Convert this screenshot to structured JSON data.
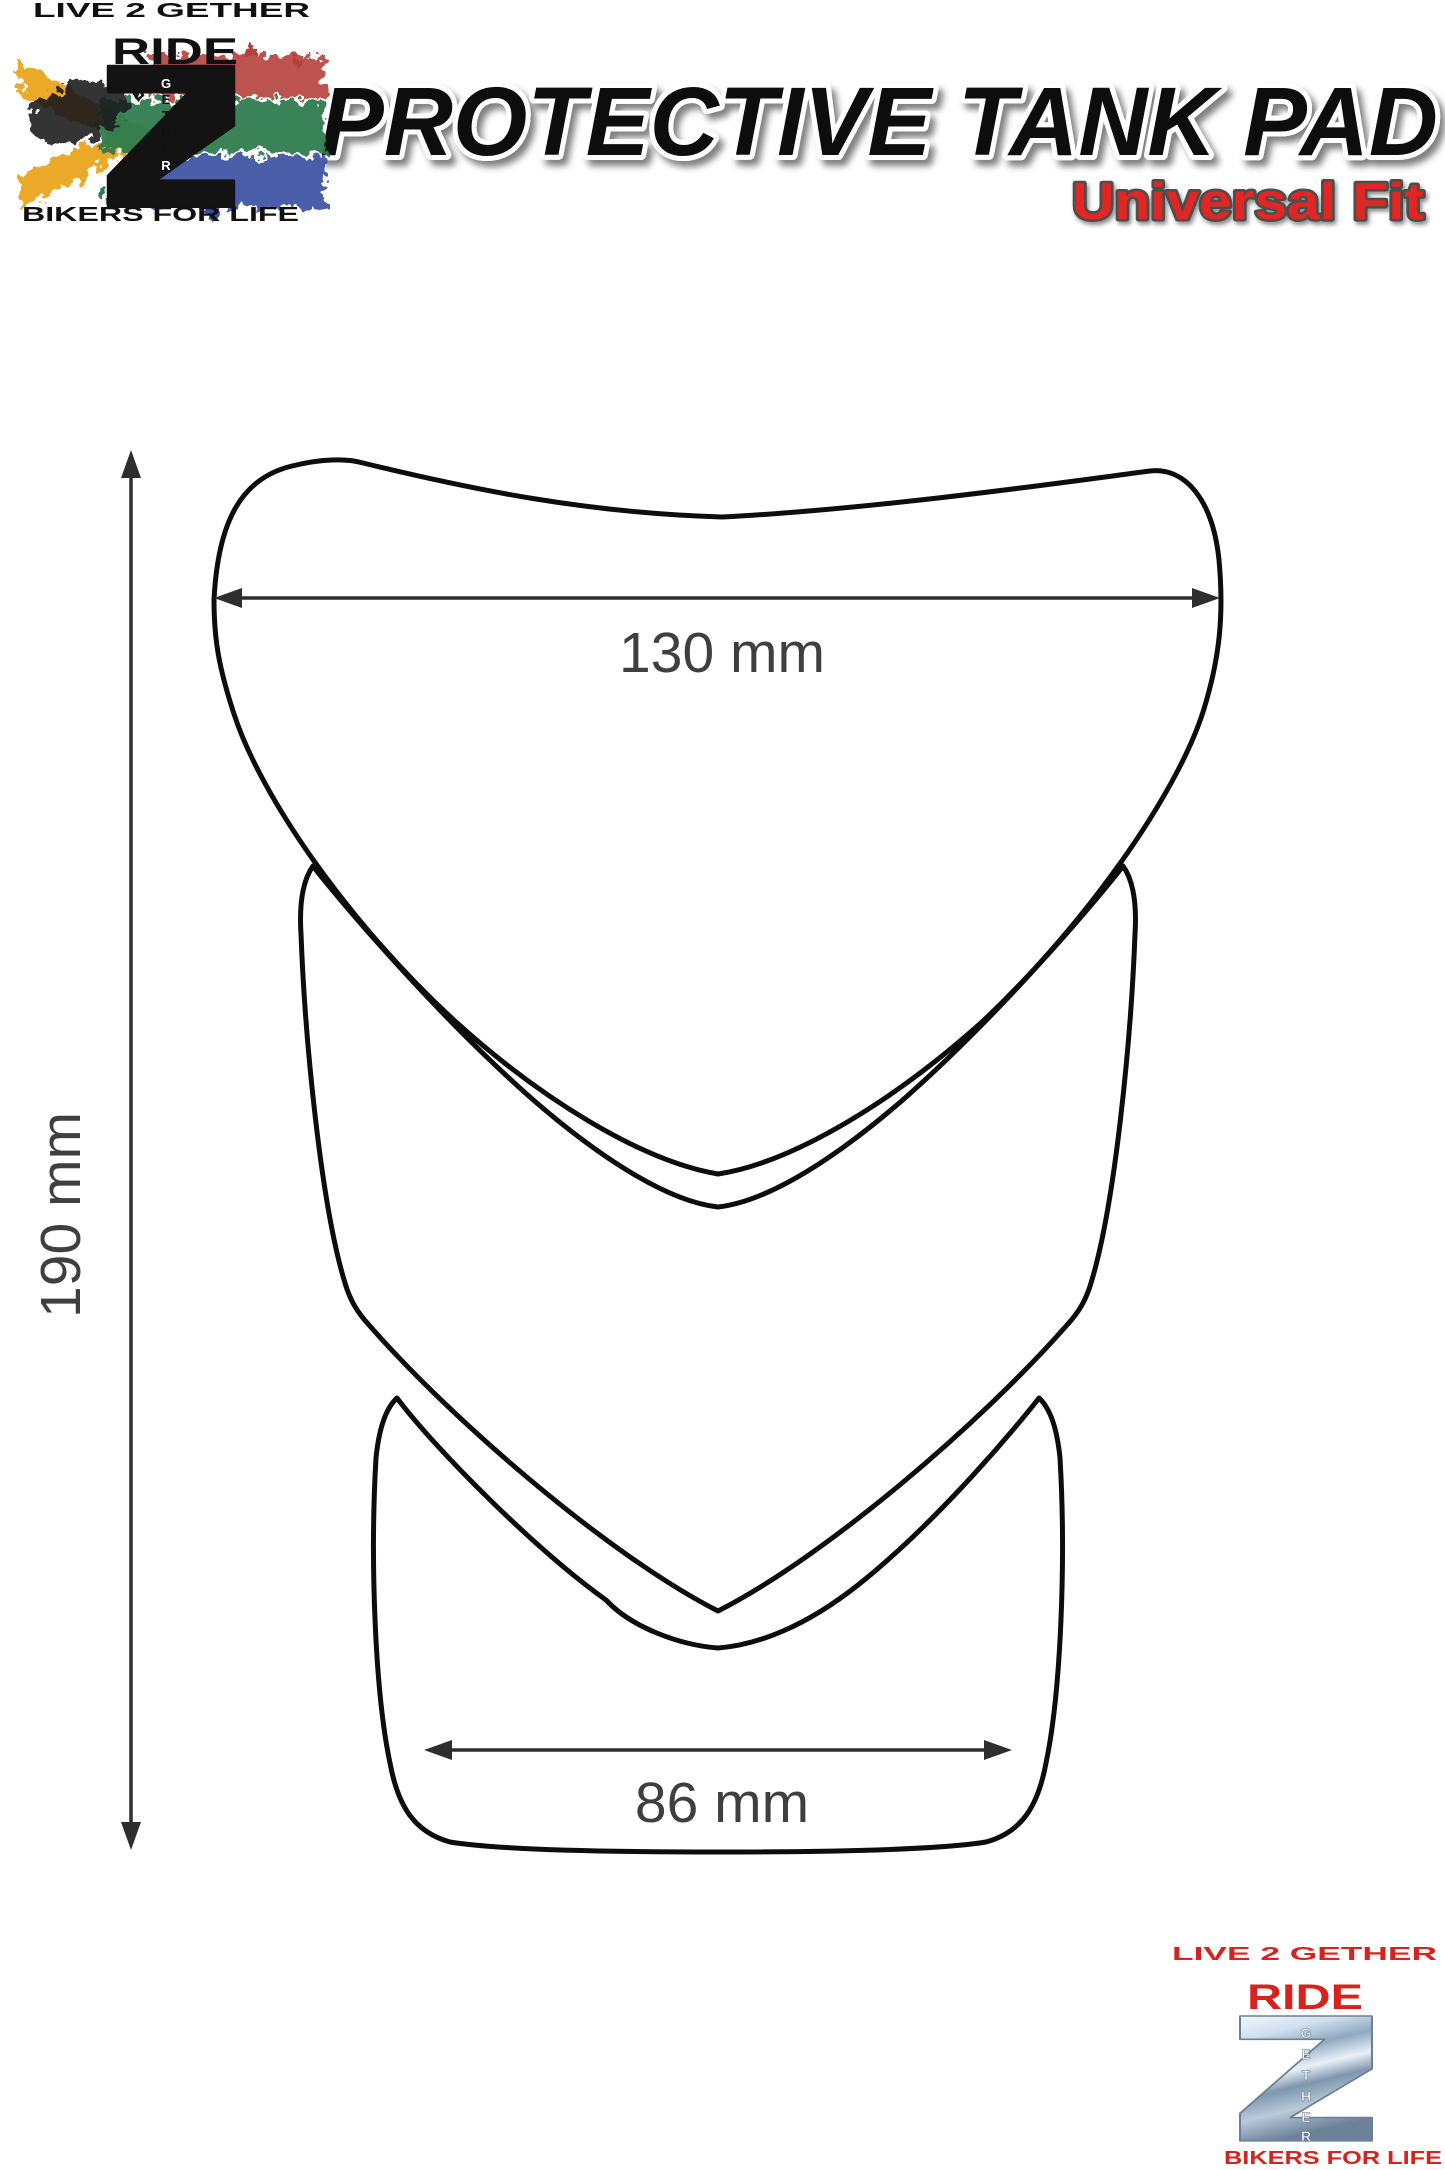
{
  "page": {
    "width": 1445,
    "height": 2170,
    "background": "#ffffff"
  },
  "header": {
    "title": "PROTECTIVE TANK PAD",
    "subtitle": "Universal Fit"
  },
  "branding": {
    "logo_top": {
      "tagline_top": "LIVE 2 GETHER",
      "ride": "RIDE",
      "numeral": "2",
      "vertical_word": [
        "G",
        "E",
        "T",
        "H",
        "E",
        "R"
      ],
      "tagline_bottom": "BIKERS FOR LIFE"
    },
    "logo_bottom": {
      "tagline_top": "LIVE 2 GETHER",
      "ride": "RIDE",
      "numeral": "2",
      "vertical_word": [
        "G",
        "E",
        "T",
        "H",
        "E",
        "R"
      ],
      "tagline_bottom": "BIKERS FOR LIFE"
    }
  },
  "diagram": {
    "type": "technical-dimension-drawing",
    "subject": "3-piece universal motorcycle tank pad outline (top, middle, bottom sections)",
    "dimensions": {
      "top_width": "130 mm",
      "bottom_width": "86 mm",
      "overall_height": "190 mm"
    }
  },
  "colors": {
    "accent_red": "#e42522",
    "logo_red": "#d6231f",
    "outline_black": "#0d0d0d",
    "dimension_gray": "#3c3c3c",
    "flag_green": "#2f7c50",
    "flag_gold": "#eaa41f",
    "flag_red": "#b5403a",
    "flag_blue": "#3b50a2",
    "flag_black": "#1c1c1c",
    "chrome_light": "#f2f7fb",
    "chrome_dark": "#6d8299"
  }
}
